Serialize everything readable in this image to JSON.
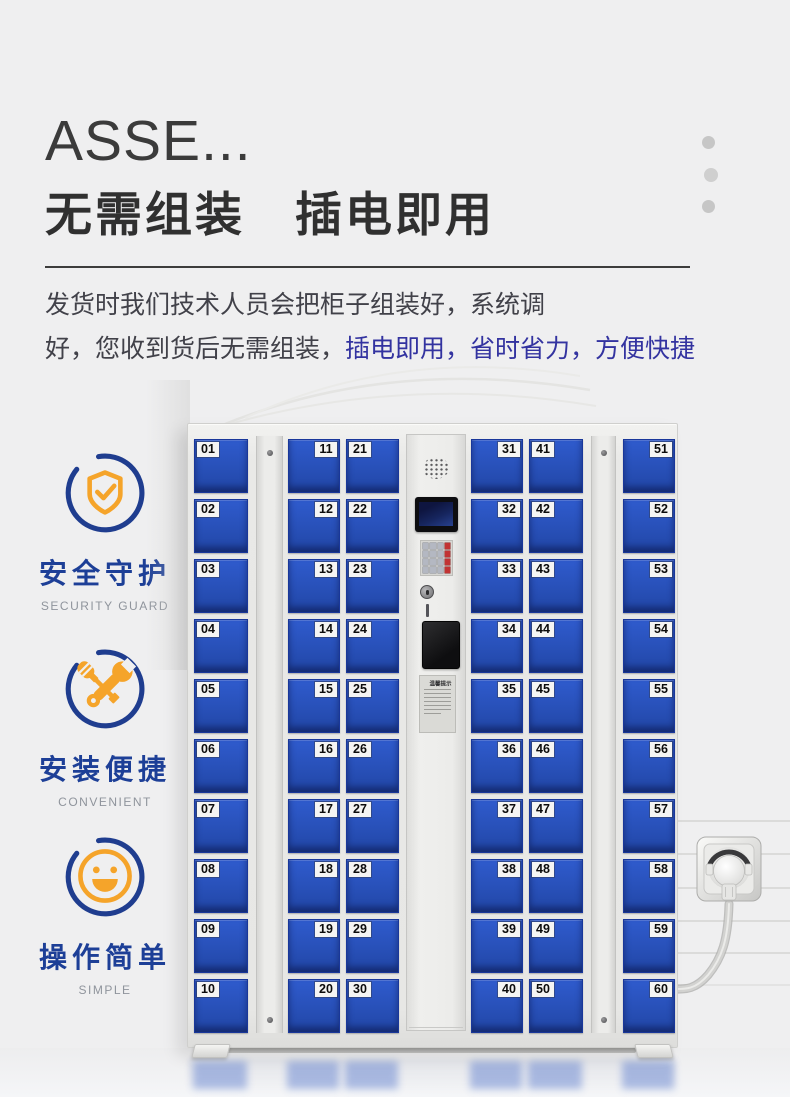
{
  "header": {
    "title_en": "ASSE...",
    "title_zh": "无需组装　插电即用"
  },
  "description": {
    "lines": [
      [
        {
          "text": "发货时我们技术人员会把柜子组装好，系统调",
          "style": "dark"
        }
      ],
      [
        {
          "text": "好，您收到货后无需组装，",
          "style": "dark"
        },
        {
          "text": "插电即用，省时省力，方便快捷",
          "style": "blue"
        }
      ]
    ]
  },
  "features": [
    {
      "icon": "shield-check-icon",
      "title": "安全守护",
      "subtitle": "SECURITY GUARD"
    },
    {
      "icon": "tools-icon",
      "title": "安装便捷",
      "subtitle": "CONVENIENT"
    },
    {
      "icon": "smiley-icon",
      "title": "操作简单",
      "subtitle": "SIMPLE"
    }
  ],
  "locker": {
    "columns": [
      {
        "id": "column-1",
        "label_side": "left",
        "doors": [
          "01",
          "02",
          "03",
          "04",
          "05",
          "06",
          "07",
          "08",
          "09",
          "10"
        ]
      },
      {
        "id": "column-2",
        "label_side": "right",
        "doors": [
          "11",
          "12",
          "13",
          "14",
          "15",
          "16",
          "17",
          "18",
          "19",
          "20"
        ]
      },
      {
        "id": "column-3",
        "label_side": "left",
        "doors": [
          "21",
          "22",
          "23",
          "24",
          "25",
          "26",
          "27",
          "28",
          "29",
          "30"
        ]
      },
      {
        "id": "column-4",
        "label_side": "right",
        "doors": [
          "31",
          "32",
          "33",
          "34",
          "35",
          "36",
          "37",
          "38",
          "39",
          "40"
        ]
      },
      {
        "id": "column-5",
        "label_side": "left",
        "doors": [
          "41",
          "42",
          "43",
          "44",
          "45",
          "46",
          "47",
          "48",
          "49",
          "50"
        ]
      },
      {
        "id": "column-6",
        "label_side": "right",
        "doors": [
          "51",
          "52",
          "53",
          "54",
          "55",
          "56",
          "57",
          "58",
          "59",
          "60"
        ]
      }
    ],
    "control_panel": {
      "notice_title": "温馨提示"
    }
  },
  "colors": {
    "door_blue": "#2a52bb",
    "accent_orange": "#f5a42a",
    "ring_blue": "#1f3d8f",
    "highlight_text_blue": "#3333a0",
    "feature_title_blue": "#1d3f97"
  }
}
